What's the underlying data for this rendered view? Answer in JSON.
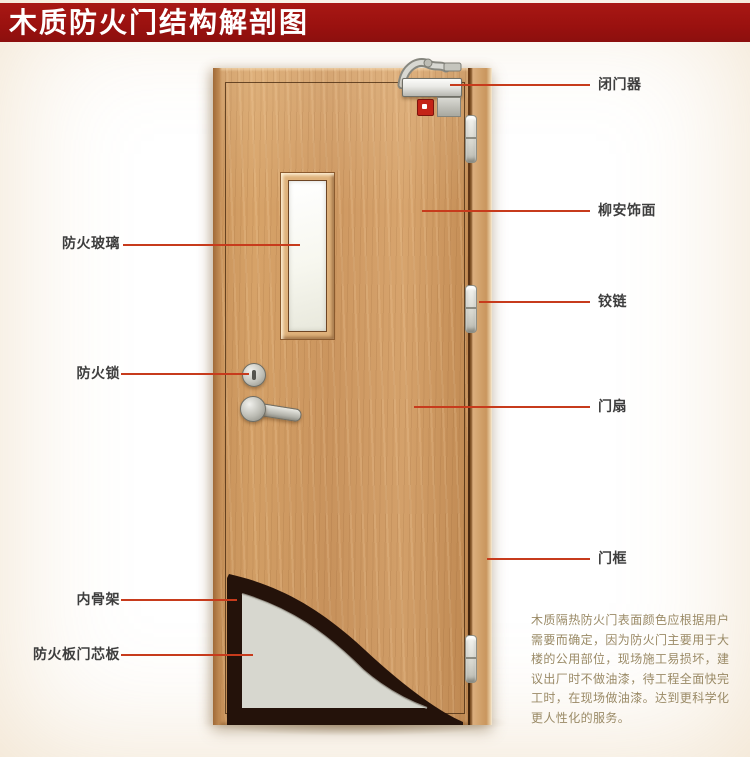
{
  "title": "木质防火门结构解剖图",
  "palette": {
    "banner_bg": "#9a110f",
    "banner_text": "#ffffff",
    "callout_line": "#c73b1c",
    "label_text": "#3e3e3e",
    "note_text": "#9a8a66",
    "background": "#f1e5c3",
    "door_wood": "#d0995f",
    "core_board_gray": "#d7d7cf",
    "skeleton_dark": "#24120a"
  },
  "callouts": {
    "left": [
      {
        "id": "fire-glass",
        "label": "防火玻璃"
      },
      {
        "id": "fire-lock",
        "label": "防火锁"
      },
      {
        "id": "inner-skeleton",
        "label": "内骨架"
      },
      {
        "id": "core-board",
        "label": "防火板门芯板"
      }
    ],
    "right": [
      {
        "id": "door-closer",
        "label": "闭门器"
      },
      {
        "id": "lauan-veneer",
        "label": "柳安饰面"
      },
      {
        "id": "hinge",
        "label": "铰链"
      },
      {
        "id": "door-leaf",
        "label": "门扇"
      },
      {
        "id": "door-frame",
        "label": "门框"
      }
    ]
  },
  "note": {
    "lines": [
      "木质隔热防火门表面颜色应根据用户",
      "需要而确定，因为防火门主要用于大",
      "楼的公用部位，现场施工易损坏，建",
      "议出厂时不做油漆，待工程全面快完",
      "工时，在现场做油漆。达到更科学化",
      "更人性化的服务。"
    ]
  }
}
